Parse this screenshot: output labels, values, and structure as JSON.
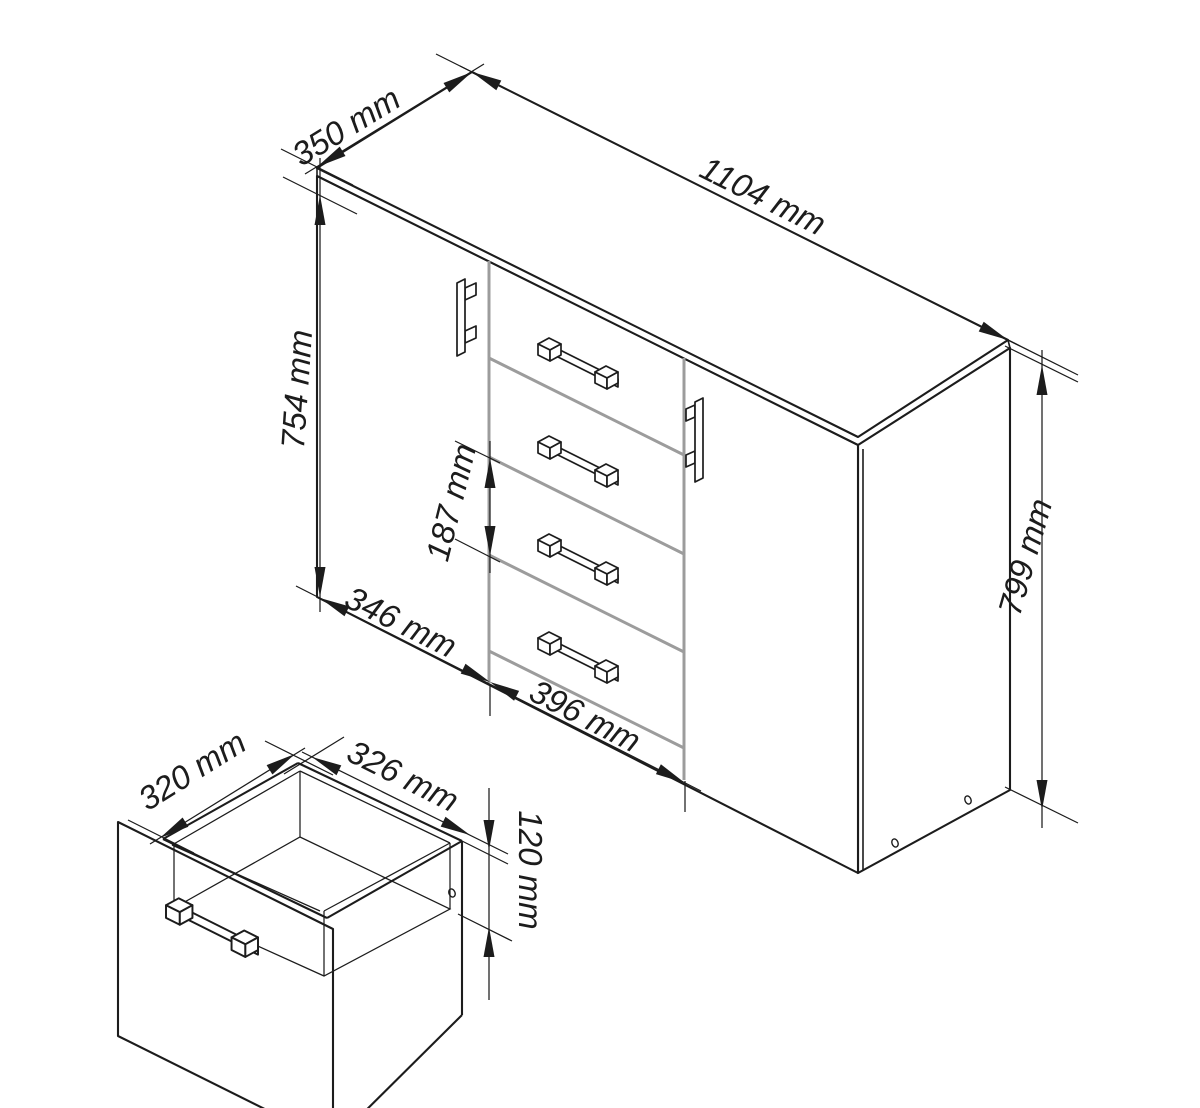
{
  "drawing": {
    "type": "furniture-technical-drawing",
    "unit": "mm",
    "views": {
      "main": {
        "label": "cabinet-isometric",
        "doors": 2,
        "drawers": 4,
        "door_handles": 2,
        "drawer_handles": 4,
        "dims": {
          "depth": "350 mm",
          "width": "1104 mm",
          "door_height": "754 mm",
          "drawer_pitch": "187 mm",
          "left_door_width": "346 mm",
          "drawer_front_width": "396 mm",
          "overall_height": "799 mm"
        }
      },
      "detail": {
        "label": "drawer-open-box",
        "dims": {
          "inner_depth": "320 mm",
          "inner_width": "326 mm",
          "inner_height": "120 mm"
        }
      }
    },
    "colors": {
      "line": "#1c1c1c",
      "gap_line": "#9c9c9c",
      "background": "#ffffff"
    }
  }
}
